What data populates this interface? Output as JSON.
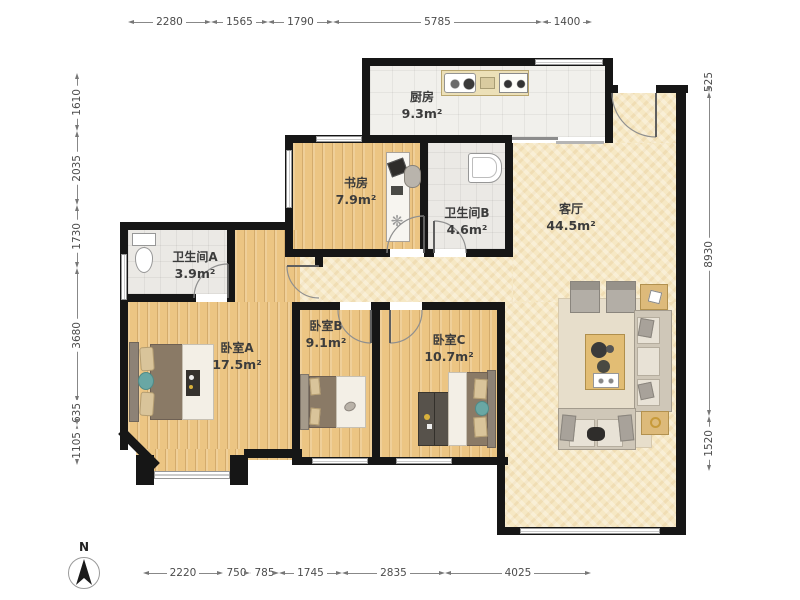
{
  "rooms": {
    "kitchen": {
      "name": "厨房",
      "area": "9.3m²"
    },
    "study": {
      "name": "书房",
      "area": "7.9m²"
    },
    "bathroom_b": {
      "name": "卫生间B",
      "area": "4.6m²"
    },
    "living_room": {
      "name": "客厅",
      "area": "44.5m²"
    },
    "bathroom_a": {
      "name": "卫生间A",
      "area": "3.9m²"
    },
    "bedroom_a": {
      "name": "卧室A",
      "area": "17.5m²"
    },
    "bedroom_b": {
      "name": "卧室B",
      "area": "9.1m²"
    },
    "bedroom_c": {
      "name": "卧室C",
      "area": "10.7m²"
    }
  },
  "dimensions_mm": {
    "top": [
      "2280",
      "1565",
      "1790",
      "5785",
      "1400"
    ],
    "left": [
      "1610",
      "2035",
      "1730",
      "3680",
      "635",
      "1105"
    ],
    "right": [
      "525",
      "8930",
      "1520"
    ],
    "bottom": [
      "2220",
      "750",
      "785",
      "1745",
      "2835",
      "4025"
    ]
  },
  "compass": {
    "label": "N"
  },
  "colors": {
    "wall": "#161616",
    "wood_floor": "#ecc583",
    "living_floor": "#f6e8c4",
    "tile_floor": "#f1f0ec",
    "bath_floor": "#ebe9e5",
    "accent_teal": "#69a7a4",
    "counter_tan": "#ddba7a",
    "bed_brown": "#8a7a66"
  }
}
